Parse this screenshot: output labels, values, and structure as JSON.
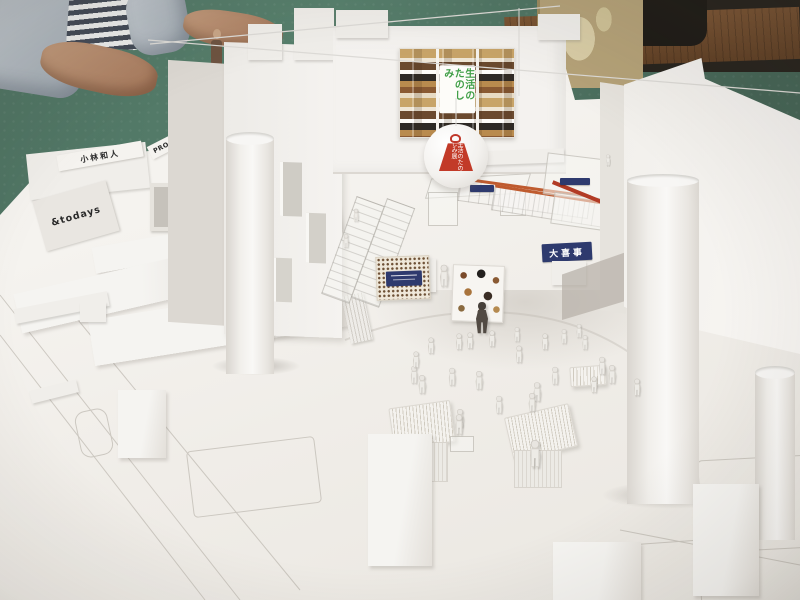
{
  "scene": {
    "subject": "Photograph of a white architectural scale model of an exhibition venue, placed on a green cutting mat; a person's hands rest on the table at the top left",
    "labels": {
      "shop_todays": "&todays",
      "shop_kobayashi": "小林和人",
      "shop_proof": "PROOF OF GILD",
      "stall_daikiji": "大喜事",
      "poster_text": "生活のたのしみ",
      "balloon_text": "生活のたのしみ展"
    },
    "colors": {
      "cutting_mat_green": "#57806d",
      "desk_wood": "#6e4b2c",
      "room_dark": "#26221c",
      "backdrop_tan": "#b5a278",
      "skin": "#b08264",
      "sleeve_blue_gray": "#aab3ba",
      "shirt_stripe_navy": "#434a56",
      "model_white": "#f1efeb",
      "sign_navy": "#2e3a6e",
      "stamp_red": "#c0392b",
      "stall_stripe_orange": "#bf5b2f",
      "poster_text_green": "#3f9e46"
    }
  },
  "figures": {
    "white": [
      [
        352,
        206,
        0.8
      ],
      [
        342,
        232,
        0.85
      ],
      [
        427,
        338,
        1
      ],
      [
        455,
        334,
        1
      ],
      [
        466,
        333,
        1
      ],
      [
        488,
        331,
        1
      ],
      [
        513,
        326,
        0.9
      ],
      [
        515,
        347,
        1.05
      ],
      [
        541,
        334,
        1
      ],
      [
        560,
        328,
        0.9
      ],
      [
        575,
        322,
        0.85
      ],
      [
        581,
        334,
        0.9
      ],
      [
        598,
        359,
        1.1
      ],
      [
        608,
        368,
        1.15
      ],
      [
        551,
        369,
        1.1
      ],
      [
        410,
        368,
        1.1
      ],
      [
        418,
        378,
        1.15
      ],
      [
        448,
        370,
        1.1
      ],
      [
        475,
        374,
        1.15
      ],
      [
        533,
        386,
        1.2
      ],
      [
        440,
        271,
        1.35
      ],
      [
        604,
        150,
        0.7
      ],
      [
        633,
        380,
        1.05
      ],
      [
        590,
        377,
        1.0
      ],
      [
        456,
        412,
        1.15
      ],
      [
        528,
        396,
        1.15
      ],
      [
        531,
        452,
        1.7
      ],
      [
        455,
        419,
        1.25
      ],
      [
        495,
        398,
        1.1
      ],
      [
        412,
        352,
        1.0
      ]
    ],
    "dark": [
      [
        478,
        318,
        2.0
      ]
    ]
  }
}
